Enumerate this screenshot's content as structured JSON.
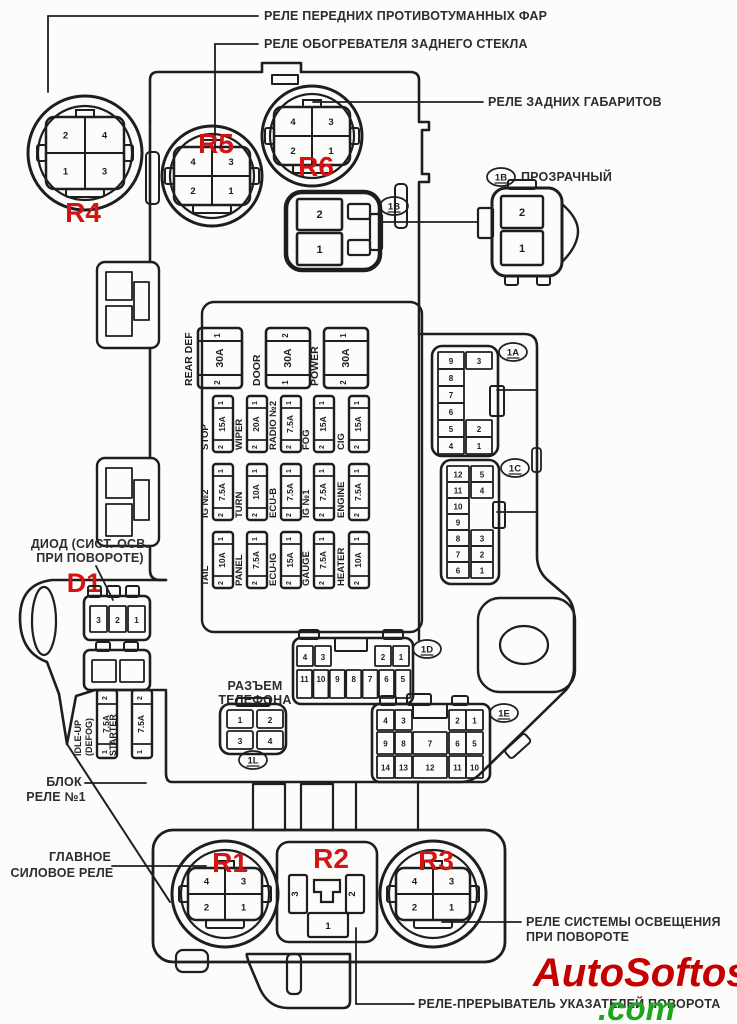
{
  "colors": {
    "ink": "#1e1e1e",
    "label_text": "#2d2d2d",
    "red_marker": "#d31414",
    "watermark_red": "#c40000",
    "watermark_green": "#1ea51e",
    "paper": "#fcfcfb"
  },
  "watermark": {
    "word": "AutoSoftos",
    "tld": ".com"
  },
  "callouts": [
    {
      "id": "front-fog-relay",
      "text": "РЕЛЕ ПЕРЕДНИХ ПРОТИВОТУМАННЫХ ФАР",
      "x": 264,
      "y": 20,
      "anchor": "start"
    },
    {
      "id": "rear-defog-relay",
      "text": "РЕЛЕ ОБОГРЕВАТЕЛЯ ЗАДНЕГО СТЕКЛА",
      "x": 264,
      "y": 48,
      "anchor": "start"
    },
    {
      "id": "rear-lights-relay",
      "text": "РЕЛЕ ЗАДНИХ ГАБАРИТОВ",
      "x": 488,
      "y": 106,
      "anchor": "start"
    },
    {
      "id": "transparent",
      "text": "ПРОЗРАЧНЫЙ",
      "x": 521,
      "y": 181,
      "anchor": "start"
    },
    {
      "id": "diode-line1",
      "text": "ДИОД (СИСТ. ОСВ.",
      "x": 90,
      "y": 548,
      "anchor": "middle"
    },
    {
      "id": "diode-line2",
      "text": "ПРИ ПОВОРОТЕ)",
      "x": 90,
      "y": 562,
      "anchor": "middle"
    },
    {
      "id": "phone-line1",
      "text": "РАЗЪЕМ",
      "x": 255,
      "y": 690,
      "anchor": "middle"
    },
    {
      "id": "phone-line2",
      "text": "ТЕЛЕФОНА",
      "x": 255,
      "y": 704,
      "anchor": "middle"
    },
    {
      "id": "block-line1",
      "text": "БЛОК",
      "x": 64,
      "y": 786,
      "anchor": "middle"
    },
    {
      "id": "block-line2",
      "text": "РЕЛЕ №1",
      "x": 56,
      "y": 801,
      "anchor": "middle"
    },
    {
      "id": "main-relay-line1",
      "text": "ГЛАВНОЕ",
      "x": 80,
      "y": 861,
      "anchor": "middle"
    },
    {
      "id": "main-relay-line2",
      "text": "СИЛОВОЕ РЕЛЕ",
      "x": 62,
      "y": 877,
      "anchor": "middle"
    },
    {
      "id": "cornering-line1",
      "text": "РЕЛЕ СИСТЕМЫ ОСВЕЩЕНИЯ",
      "x": 526,
      "y": 926,
      "anchor": "start"
    },
    {
      "id": "cornering-line2",
      "text": "ПРИ ПОВОРОТЕ",
      "x": 526,
      "y": 941,
      "anchor": "start"
    },
    {
      "id": "flasher",
      "text": "РЕЛЕ-ПРЕРЫВАТЕЛЬ УКАЗАТЕЛЕЙ ПОВОРОТА",
      "x": 418,
      "y": 1008,
      "anchor": "start"
    }
  ],
  "leader_lines": [
    [
      48,
      16,
      258,
      16
    ],
    [
      48,
      16,
      48,
      92
    ],
    [
      215,
      44,
      258,
      44
    ],
    [
      215,
      44,
      215,
      150
    ],
    [
      313,
      102,
      483,
      102
    ],
    [
      380,
      222,
      477,
      222
    ],
    [
      497,
      390,
      536,
      390
    ],
    [
      497,
      512,
      536,
      512
    ],
    [
      85,
      783,
      146,
      783
    ],
    [
      112,
      866,
      206,
      866
    ],
    [
      442,
      922,
      521,
      922
    ],
    [
      356,
      928,
      356,
      1004
    ],
    [
      356,
      1004,
      414,
      1004
    ],
    [
      96,
      566,
      113,
      600
    ]
  ],
  "badges": [
    {
      "label": "1B",
      "x": 394,
      "y": 206
    },
    {
      "label": "1B",
      "x": 501,
      "y": 177
    },
    {
      "label": "1A",
      "x": 513,
      "y": 352
    },
    {
      "label": "1C",
      "x": 515,
      "y": 468
    },
    {
      "label": "1D",
      "x": 427,
      "y": 649
    },
    {
      "label": "1E",
      "x": 504,
      "y": 713
    },
    {
      "label": "1L",
      "x": 253,
      "y": 760
    }
  ],
  "relays_round": [
    {
      "id": "R4",
      "cx": 85,
      "cy": 153,
      "ro": 57,
      "ri": 47,
      "cw": 78,
      "ch": 72,
      "pins": [
        [
          "2",
          "4"
        ],
        [
          "1",
          "3"
        ]
      ],
      "lx": 83,
      "ly": 222
    },
    {
      "id": "R5",
      "cx": 212,
      "cy": 176,
      "ro": 50,
      "ri": 42,
      "cw": 76,
      "ch": 58,
      "pins": [
        [
          "4",
          "3"
        ],
        [
          "2",
          "1"
        ]
      ],
      "lx": 216,
      "ly": 153
    },
    {
      "id": "R6",
      "cx": 312,
      "cy": 136,
      "ro": 50,
      "ri": 42,
      "cw": 76,
      "ch": 58,
      "pins": [
        [
          "4",
          "3"
        ],
        [
          "2",
          "1"
        ]
      ],
      "lx": 316,
      "ly": 176
    },
    {
      "id": "R1",
      "cx": 225,
      "cy": 894,
      "ro": 53,
      "ri": 44,
      "cw": 74,
      "ch": 52,
      "pins": [
        [
          "4",
          "3"
        ],
        [
          "2",
          "1"
        ]
      ],
      "lx": 230,
      "ly": 872
    },
    {
      "id": "R3",
      "cx": 433,
      "cy": 894,
      "ro": 53,
      "ri": 44,
      "cw": 74,
      "ch": 52,
      "pins": [
        [
          "4",
          "3"
        ],
        [
          "2",
          "1"
        ]
      ],
      "lx": 436,
      "ly": 870
    }
  ],
  "relay_r2": {
    "id": "R2",
    "x": 277,
    "y": 842,
    "w": 100,
    "h": 100,
    "pin_left": "3",
    "pin_right": "2",
    "pin_bottom": "1",
    "lx": 331,
    "ly": 868
  },
  "diode_marker": {
    "id": "D1",
    "x": 84,
    "y": 592
  },
  "big_fuses": [
    {
      "label": "REAR DEF",
      "amp": "30A",
      "pin_top": "1",
      "pin_bottom": "2",
      "x": 198,
      "y": 328
    },
    {
      "label": "DOOR",
      "amp": "30A",
      "pin_top": "2",
      "pin_bottom": "1",
      "x": 266,
      "y": 328
    },
    {
      "label": "POWER",
      "amp": "30A",
      "pin_top": "1",
      "pin_bottom": "2",
      "x": 324,
      "y": 328
    }
  ],
  "fuse_cols": [
    213,
    247,
    281,
    314,
    349
  ],
  "fuse_rows": [
    {
      "y": 396,
      "fuses": [
        {
          "label": "STOP",
          "amp": "15A",
          "pin_top": "1",
          "pin_bottom": "2"
        },
        {
          "label": "WIPER",
          "amp": "20A",
          "pin_top": "1",
          "pin_bottom": "2"
        },
        {
          "label": "RADIO №2",
          "amp": "7.5A",
          "pin_top": "1",
          "pin_bottom": "2"
        },
        {
          "label": "FOG",
          "amp": "15A",
          "pin_top": "1",
          "pin_bottom": "2"
        },
        {
          "label": "CIG",
          "amp": "15A",
          "pin_top": "1",
          "pin_bottom": "2"
        }
      ]
    },
    {
      "y": 464,
      "fuses": [
        {
          "label": "IG №2",
          "amp": "7.5A",
          "pin_top": "1",
          "pin_bottom": "2"
        },
        {
          "label": "TURN",
          "amp": "10A",
          "pin_top": "1",
          "pin_bottom": "2"
        },
        {
          "label": "ECU-B",
          "amp": "7.5A",
          "pin_top": "1",
          "pin_bottom": "2"
        },
        {
          "label": "IG №1",
          "amp": "7.5A",
          "pin_top": "1",
          "pin_bottom": "2"
        },
        {
          "label": "ENGINE",
          "amp": "7.5A",
          "pin_top": "1",
          "pin_bottom": "2"
        }
      ]
    },
    {
      "y": 532,
      "fuses": [
        {
          "label": "TAIL",
          "amp": "10A",
          "pin_top": "1",
          "pin_bottom": "2"
        },
        {
          "label": "PANEL",
          "amp": "7.5A",
          "pin_top": "1",
          "pin_bottom": "2"
        },
        {
          "label": "ECU-IG",
          "amp": "15A",
          "pin_top": "1",
          "pin_bottom": "2"
        },
        {
          "label": "GAUGE",
          "amp": "7.5A",
          "pin_top": "1",
          "pin_bottom": "2"
        },
        {
          "label": "HEATER",
          "amp": "10A",
          "pin_top": "1",
          "pin_bottom": "2"
        }
      ]
    }
  ],
  "side_fuses": [
    {
      "labels": [
        "IDLE-UP",
        "(DEFOG)"
      ],
      "amp": "7.5A",
      "pin_top": "2",
      "pin_bottom": "1",
      "x": 97,
      "y": 690
    },
    {
      "labels": [
        "STARTER"
      ],
      "amp": "7.5A",
      "pin_top": "2",
      "pin_bottom": "1",
      "x": 132,
      "y": 690
    }
  ],
  "connector_1a": {
    "left": [
      "9",
      "8",
      "7",
      "6",
      "5",
      "4"
    ],
    "right": [
      "3",
      "",
      "",
      "",
      "2",
      "1"
    ]
  },
  "connector_1c": {
    "left": [
      "12",
      "11",
      "10",
      "9",
      "8",
      "7",
      "6"
    ],
    "right": [
      "5",
      "4",
      "",
      "",
      "3",
      "2",
      "1"
    ]
  },
  "connector_1d": {
    "top": [
      "4",
      "3",
      "2",
      "1"
    ],
    "bottom": [
      "11",
      "10",
      "9",
      "8",
      "7",
      "6",
      "5"
    ]
  },
  "connector_1e": {
    "rows": [
      [
        "4",
        "3",
        "",
        "2",
        "1"
      ],
      [
        "9",
        "8",
        "7",
        "6",
        "5"
      ],
      [
        "14",
        "13",
        "12",
        "11",
        "10"
      ]
    ]
  },
  "connector_1l": {
    "rows": [
      [
        "1",
        "2"
      ],
      [
        "3",
        "4"
      ]
    ]
  },
  "connector_1b_left": {
    "pins": [
      "2",
      "1"
    ]
  },
  "connector_1b_right": {
    "pins": [
      "2",
      "1"
    ]
  },
  "connector_d1": {
    "pins": [
      "3",
      "2",
      "1"
    ]
  }
}
